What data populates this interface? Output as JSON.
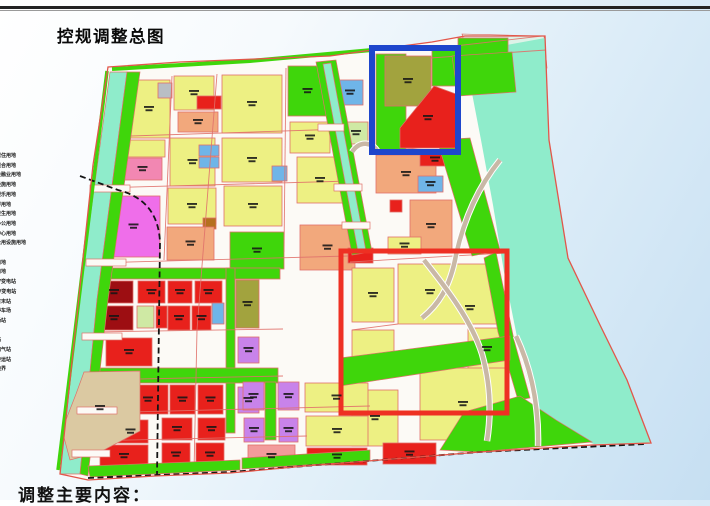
{
  "title": "控规调整总图",
  "footer": "调整主要内容：",
  "legend": {
    "items": [
      "二类居住用地",
      "商住混合用地",
      "商业金融业用地",
      "公共设施用地",
      "文化娱乐用地",
      "中小学用地",
      "医疗卫生用地",
      "行政办公用地",
      "社区中心用地",
      "市政公用设施用地",
      "绿地",
      "广场用地",
      "道路用地",
      "110KV变电站",
      "220KV变电站",
      "公交首末站",
      "社会停车场",
      "公交场站",
      "泵站",
      "消防站",
      "加油加气站",
      "垃圾转运站",
      "规划边界",
      "铁路"
    ]
  },
  "map": {
    "palette": {
      "y": "#edf083",
      "g": "#3fd60b",
      "ol": "#a2a33e",
      "r": "#e8211c",
      "dr": "#9d0e12",
      "sa": "#f2a87c",
      "br": "#b5701f",
      "mg": "#ef6eea",
      "pk": "#f287b2",
      "pk2": "#f29b9b",
      "pu": "#c883ea",
      "bl": "#6fb5e8",
      "cy": "#8feccb",
      "tn": "#dbc9a2",
      "gy": "#b9bec4",
      "lg": "#cfe9a4",
      "base": "#fcfaf6",
      "boundary": "#e2564a",
      "road_line": "#e0706a",
      "rail": "#151515",
      "tan_road": "#c9b8a6",
      "water_pale": "#ddf3e8",
      "label_ink": "#161616",
      "highlight_blue": "#1e46cc",
      "highlight_red": "#ee3023"
    },
    "boundary": "108,67 180,62 280,58 330,56 372,50 432,42 465,36 545,36 549,140 568,258 600,325 627,380 651,443 592,445 480,452 305,466 230,473 155,476 88,480 60,474 93,165",
    "water": "468,52 545,38 549,140 568,258 600,325 627,380 651,443 594,444 552,430 533,400 518,342 504,272 493,205 481,140 471,88",
    "water_pale": "462,34 544,36 547,68 468,56",
    "parcels": [
      [
        128,
        80,
        42,
        58,
        "y",
        1
      ],
      [
        158,
        83,
        14,
        15,
        "gy",
        0
      ],
      [
        174,
        76,
        40,
        34,
        "y",
        1
      ],
      [
        197,
        96,
        24,
        13,
        "r",
        0
      ],
      [
        178,
        112,
        40,
        20,
        "sa",
        1
      ],
      [
        125,
        140,
        40,
        17,
        "y",
        0
      ],
      [
        123,
        158,
        39,
        22,
        "pk",
        1
      ],
      [
        170,
        138,
        45,
        48,
        "y",
        1
      ],
      [
        199,
        145,
        20,
        11,
        "bl",
        0
      ],
      [
        199,
        157,
        20,
        11,
        "bl",
        0
      ],
      [
        107,
        196,
        53,
        61,
        "mg",
        1
      ],
      [
        168,
        188,
        48,
        36,
        "y",
        1
      ],
      [
        203,
        218,
        13,
        11,
        "br",
        0
      ],
      [
        167,
        227,
        47,
        33,
        "sa",
        1
      ],
      [
        222,
        75,
        60,
        58,
        "y",
        1
      ],
      [
        288,
        66,
        39,
        50,
        "g",
        1
      ],
      [
        337,
        80,
        26,
        25,
        "bl",
        1
      ],
      [
        222,
        138,
        60,
        44,
        "y",
        1
      ],
      [
        290,
        122,
        40,
        31,
        "y",
        1
      ],
      [
        297,
        157,
        46,
        46,
        "y",
        1
      ],
      [
        224,
        186,
        58,
        40,
        "y",
        1
      ],
      [
        272,
        166,
        15,
        15,
        "bl",
        0
      ],
      [
        230,
        232,
        54,
        37,
        "g",
        1
      ],
      [
        300,
        225,
        55,
        45,
        "sa",
        1
      ],
      [
        344,
        122,
        24,
        22,
        "lg",
        1
      ],
      [
        376,
        54,
        30,
        96,
        "g",
        0
      ],
      [
        385,
        56,
        46,
        50,
        "ol",
        1
      ],
      [
        432,
        50,
        28,
        36,
        "g",
        0
      ],
      [
        458,
        38,
        50,
        52,
        "g",
        0
      ],
      [
        376,
        155,
        60,
        38,
        "sa",
        1
      ],
      [
        418,
        176,
        25,
        16,
        "bl",
        1
      ],
      [
        420,
        153,
        30,
        13,
        "r",
        1
      ],
      [
        390,
        200,
        12,
        12,
        "r",
        0
      ],
      [
        410,
        200,
        42,
        52,
        "sa",
        1
      ],
      [
        388,
        237,
        33,
        17,
        "y",
        1
      ],
      [
        348,
        248,
        25,
        15,
        "r",
        0
      ],
      [
        352,
        268,
        42,
        54,
        "y",
        1
      ],
      [
        398,
        264,
        100,
        60,
        "y",
        0
      ],
      [
        352,
        330,
        42,
        27,
        "y",
        0
      ],
      [
        468,
        328,
        38,
        42,
        "y",
        1
      ],
      [
        352,
        390,
        46,
        56,
        "y",
        1
      ],
      [
        420,
        368,
        86,
        72,
        "y",
        1
      ],
      [
        346,
        385,
        14,
        11,
        "r",
        0
      ],
      [
        351,
        424,
        11,
        21,
        "br",
        0
      ],
      [
        95,
        268,
        185,
        11,
        "g",
        0
      ],
      [
        95,
        281,
        38,
        22,
        "dr",
        1
      ],
      [
        138,
        281,
        27,
        22,
        "r",
        1
      ],
      [
        95,
        306,
        38,
        24,
        "dr",
        1
      ],
      [
        137,
        306,
        17,
        22,
        "lg",
        0
      ],
      [
        156,
        306,
        11,
        22,
        "r",
        0
      ],
      [
        168,
        281,
        24,
        22,
        "r",
        1
      ],
      [
        195,
        281,
        27,
        22,
        "r",
        1
      ],
      [
        168,
        306,
        22,
        24,
        "r",
        1
      ],
      [
        192,
        306,
        19,
        24,
        "r",
        1
      ],
      [
        212,
        303,
        12,
        21,
        "bl",
        0
      ],
      [
        236,
        280,
        23,
        48,
        "ol",
        1
      ],
      [
        226,
        268,
        9,
        165,
        "g",
        0
      ],
      [
        95,
        368,
        183,
        15,
        "g",
        0
      ],
      [
        106,
        338,
        46,
        28,
        "r",
        1
      ],
      [
        238,
        337,
        21,
        26,
        "pu",
        1
      ],
      [
        128,
        385,
        40,
        29,
        "r",
        1
      ],
      [
        170,
        385,
        25,
        29,
        "r",
        1
      ],
      [
        198,
        385,
        25,
        29,
        "r",
        1
      ],
      [
        238,
        387,
        21,
        26,
        "pu",
        1
      ],
      [
        113,
        420,
        35,
        23,
        "r",
        1
      ],
      [
        100,
        445,
        48,
        22,
        "r",
        1
      ],
      [
        162,
        418,
        30,
        22,
        "r",
        1
      ],
      [
        198,
        418,
        27,
        22,
        "r",
        1
      ],
      [
        162,
        443,
        28,
        23,
        "r",
        1
      ],
      [
        196,
        443,
        28,
        23,
        "r",
        1
      ],
      [
        243,
        382,
        21,
        28,
        "pu",
        1
      ],
      [
        278,
        382,
        21,
        28,
        "pu",
        1
      ],
      [
        265,
        382,
        11,
        58,
        "g",
        0
      ],
      [
        244,
        418,
        20,
        24,
        "pu",
        1
      ],
      [
        279,
        418,
        19,
        24,
        "pu",
        1
      ],
      [
        305,
        383,
        63,
        29,
        "y",
        1
      ],
      [
        306,
        416,
        62,
        30,
        "y",
        1
      ],
      [
        307,
        448,
        60,
        17,
        "r",
        1
      ],
      [
        248,
        445,
        47,
        22,
        "pk2",
        1
      ],
      [
        383,
        443,
        53,
        21,
        "r",
        1
      ]
    ],
    "polys": [
      {
        "pts": "110,72 127,72 97,300 80,474 60,474 79,300",
        "c": "cy"
      },
      {
        "pts": "127,72 140,72 108,300 88,476 80,474 97,300",
        "c": "g"
      },
      {
        "pts": "316,62 336,60 372,252 352,255",
        "c": "g"
      },
      {
        "pts": "323,64 331,63 366,251 358,252",
        "c": "cy"
      },
      {
        "pts": "437,140 470,138 500,250 472,256",
        "c": "g"
      },
      {
        "pts": "496,252 514,340 530,398 518,400 498,332 484,258",
        "c": "g"
      },
      {
        "pts": "452,56 512,52 516,92 458,96",
        "c": "g"
      },
      {
        "pts": "434,86 456,94 456,148 400,148 400,128",
        "c": "r"
      },
      {
        "pts": "88,466 240,460 240,470 90,477",
        "c": "g"
      },
      {
        "pts": "242,458 370,450 370,461 242,469",
        "c": "g"
      },
      {
        "pts": "440,450 464,412 520,396 556,420 592,442 478,452",
        "c": "g"
      },
      {
        "pts": "340,358 510,336 510,360 340,386",
        "c": "g"
      },
      {
        "pts": "84,372 140,371 140,431 100,452 70,460 62,430 76,394",
        "c": "tn"
      }
    ],
    "roads_minor": [
      "M100,137 L345,129",
      "M97,188 L350,181",
      "M94,263 L348,256",
      "M93,332 L283,329",
      "M91,380 L283,376",
      "M89,413 L370,406",
      "M87,441 L307,436",
      "M172,76 L164,260",
      "M217,74 L197,330 L194,472",
      "M286,68 L284,252",
      "M350,262 L505,253",
      "M398,324 L352,330",
      "M420,50 L542,36",
      "M430,58 L546,50",
      "M376,152 L460,144"
    ],
    "road_bars": [
      [
        90,
        185,
        40,
        7
      ],
      [
        86,
        259,
        40,
        7
      ],
      [
        82,
        333,
        40,
        7
      ],
      [
        77,
        407,
        40,
        7
      ],
      [
        72,
        450,
        38,
        7
      ],
      [
        318,
        124,
        26,
        7
      ],
      [
        334,
        184,
        28,
        7
      ],
      [
        342,
        222,
        28,
        7
      ]
    ],
    "tan_roads": [
      "M500,160 C474,192 462,228 456,255 C450,288 438,305 422,318",
      "M424,260 C448,290 472,322 482,354 C491,386 491,416 487,441",
      "M516,336 C530,366 539,402 538,446",
      "M352,152 C360,140 372,142 378,152"
    ],
    "green_paths": [
      {
        "d": "M112,69 L250,61 L372,50",
        "w": 4
      },
      {
        "d": "M107,71 L58,470",
        "w": 3.5
      }
    ],
    "railways": [
      "M80,176 L118,190 Q158,200 160,242 L157,476",
      "M88,478 L230,472 L480,452 L646,444"
    ],
    "highlights": {
      "blue": [
        372,
        48,
        86,
        104
      ],
      "red": [
        341,
        251,
        166,
        162
      ]
    },
    "extra_labels": [
      [
        430,
        292
      ],
      [
        470,
        308
      ],
      [
        100,
        408
      ],
      [
        428,
        118
      ]
    ]
  }
}
